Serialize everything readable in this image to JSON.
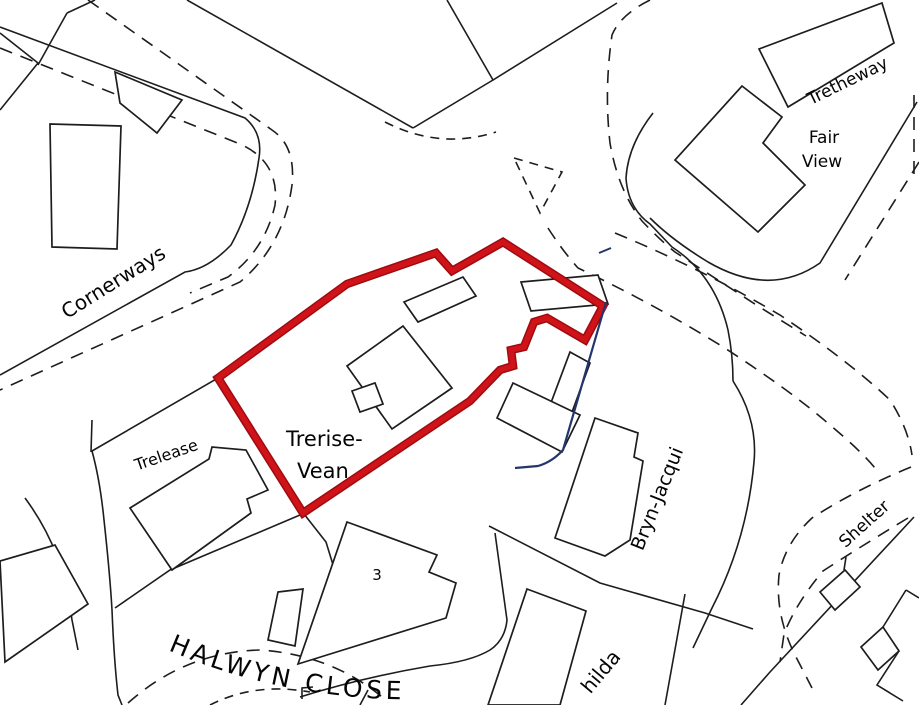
{
  "map": {
    "type": "ordnance-survey-site-plan",
    "colors": {
      "boundary_red_outer": "#9d0b10",
      "boundary_red": "#cf1318",
      "parcel_blue": "#23356b",
      "line_black": "#1d1d1d",
      "background": "#ffffff"
    },
    "labels": {
      "tretheway": "Tretheway",
      "fair_view_line1": "Fair",
      "fair_view_line2": "View",
      "cornerways": "Cornerways",
      "trerise_vean_line1": "Trerise-",
      "trerise_vean_line2": "Vean",
      "trelease": "Trelease",
      "plot_number_3": "3",
      "halwyn_close": "HALWYN CLOSE",
      "bryn_jacqui": "Bryn-Jacqui",
      "shelter": "Shelter",
      "hilda_partial": "hilda"
    }
  }
}
